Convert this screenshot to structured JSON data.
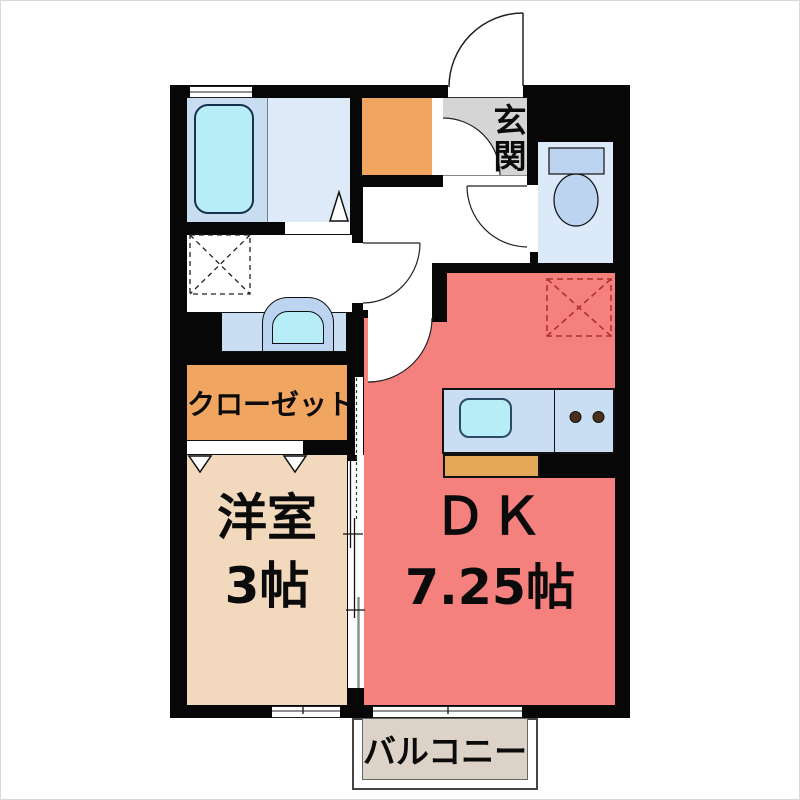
{
  "title": "apartment-floor-plan",
  "labels": {
    "entrance": "玄関",
    "closet": "クローゼット",
    "western_room": "洋室",
    "western_room_size": "3帖",
    "dk": "ＤＫ",
    "dk_size": "7.25帖",
    "balcony": "バルコニー"
  },
  "colors": {
    "wall": "#070707",
    "dk": "#f5817f",
    "beige": "#f2d8bc",
    "orange": "#f0a661",
    "bath": "#c9ddf1",
    "bath2": "#dfeaf8",
    "tub": "#b6edf6",
    "toilet": "#dbe9f9",
    "counter": "#cadef3",
    "fixture": "#bdd4f1",
    "tan": "#e3a858",
    "genkan": "#d5d5d5",
    "balcony": "#dcd2c8",
    "fridge_dash": "#b03030"
  },
  "icons": [
    "bathtub-icon",
    "washing-machine-space-icon",
    "washbasin-icon",
    "toilet-icon",
    "shoe-cabinet-icon",
    "kitchen-sink-icon",
    "stove-burners-icon",
    "refrigerator-space-icon",
    "door-swing-icon",
    "sliding-door-icon",
    "folding-door-icon",
    "window-icon"
  ]
}
